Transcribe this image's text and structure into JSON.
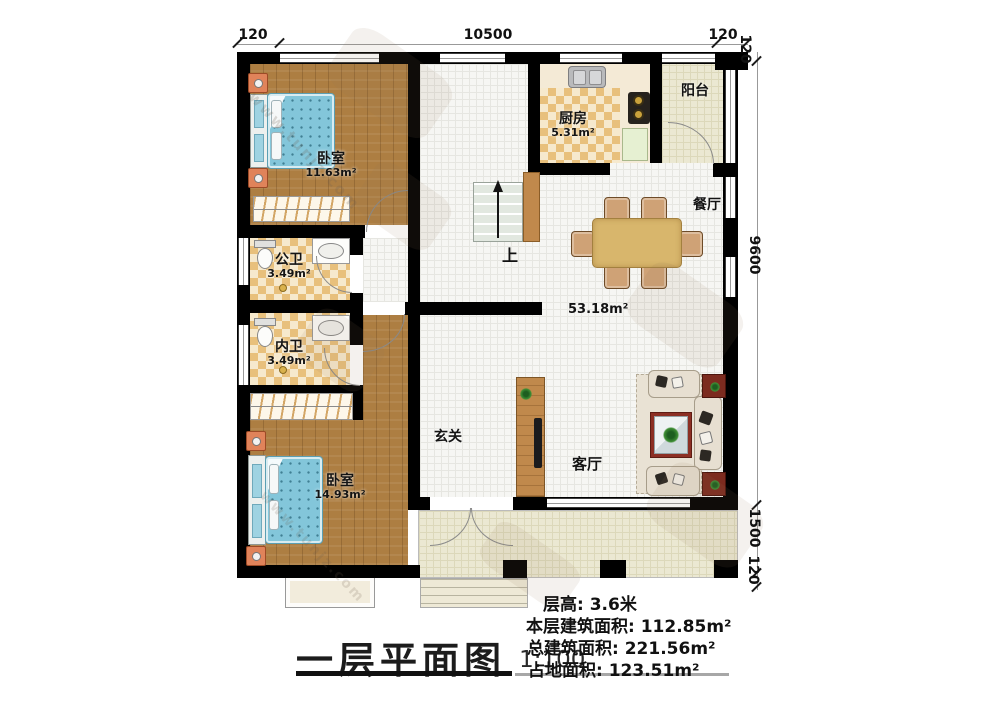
{
  "title": {
    "text": "一层平面图",
    "scale": "1:100"
  },
  "info": {
    "line1": "层高: 3.6米",
    "line2": "本层建筑面积: 112.85m²",
    "line3": "总建筑面积: 221.56m²",
    "line4": "占地面积: 123.51m²"
  },
  "dimensions": {
    "top_left": "120",
    "top_span": "10500",
    "top_right": "120",
    "top_corner": "120",
    "right_span": "9600",
    "right_porch": "1500",
    "right_bottom": "120"
  },
  "rooms": {
    "bedroom_top": {
      "name": "卧室",
      "area": "11.63m²"
    },
    "kitchen": {
      "name": "厨房",
      "area": "5.31m²"
    },
    "balcony": {
      "name": "阳台"
    },
    "dining": {
      "name": "餐厅"
    },
    "bath_public": {
      "name": "公卫",
      "area": "3.49m²"
    },
    "bath_private": {
      "name": "内卫",
      "area": "3.49m²"
    },
    "open_area": {
      "area": "53.18m²"
    },
    "foyer": {
      "name": "玄关"
    },
    "living": {
      "name": "客厅"
    },
    "bedroom_bottom": {
      "name": "卧室",
      "area": "14.93m²"
    }
  },
  "stairs": {
    "up_label": "上"
  },
  "watermark": {
    "url": "www.tunjz.com"
  },
  "colors": {
    "wall": "#000000",
    "wood_floor": "#ad7e42",
    "mattress_blue": "#83c6da",
    "checker_tile": "#e8c07c",
    "pale_tile": "#ebe8d2",
    "dining_table": "#d8b66c",
    "rug_red": "#8c2f24",
    "sofa_cream": "#e7dfd1",
    "cabinet_wood": "#c0894c"
  }
}
